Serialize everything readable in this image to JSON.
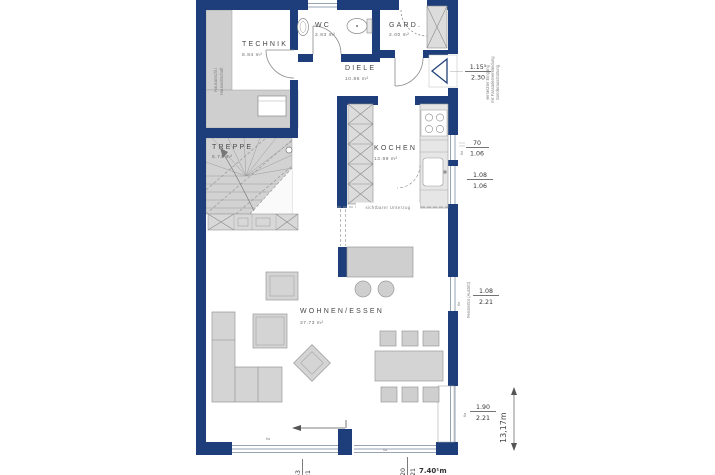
{
  "colors": {
    "wall": "#1d3e7a",
    "furniture": "#d4d4d4",
    "floor": "#ffffff",
    "zone_gray": "#cfcfcf"
  },
  "rooms": {
    "technik": {
      "name": "TECHNIK",
      "area": "8.84 m²"
    },
    "wc": {
      "name": "WC",
      "area": "2.83 m²"
    },
    "gard": {
      "name": "GARD.",
      "area": "2.00 m²"
    },
    "diele": {
      "name": "DIELE",
      "area": "10.86 m²"
    },
    "kochen": {
      "name": "KOCHEN",
      "area": "13.99 m²"
    },
    "treppe": {
      "name": "TREPPE",
      "area": "5.74 m²"
    },
    "wohnen": {
      "name": "WOHNEN/ESSEN",
      "area": "37.73 m²"
    }
  },
  "annotations": {
    "hausanschluss_line1": "Hausanschl./",
    "hausanschluss_line2": "Hauswirtschaft",
    "unterzug": "sichtbarer Unterzug",
    "entrance_note_line1": "versetzter Eingang",
    "entrance_note_line2": "mit Fassadenverkleidung",
    "entrance_note_line3": "Sonderausstattung",
    "window_note": "Fenstertür (Austritt)",
    "window_marker": "fla"
  },
  "dimensions": {
    "entrance_w": "1.15⁵",
    "entrance_h": "2.30",
    "win1_w": "70",
    "win1_h": "1.06",
    "win2_w": "1.08",
    "win2_h": "1.06",
    "win3_w": "1.08",
    "win3_h": "2.21",
    "win4_w": "1.90",
    "win4_h": "2.21",
    "bottom_left_w": "2.53",
    "bottom_left_h": "2.21",
    "bottom_right_w": "3.20",
    "bottom_right_h": "2.21",
    "total_width": "7.40¹m",
    "total_height": "13,17m"
  }
}
